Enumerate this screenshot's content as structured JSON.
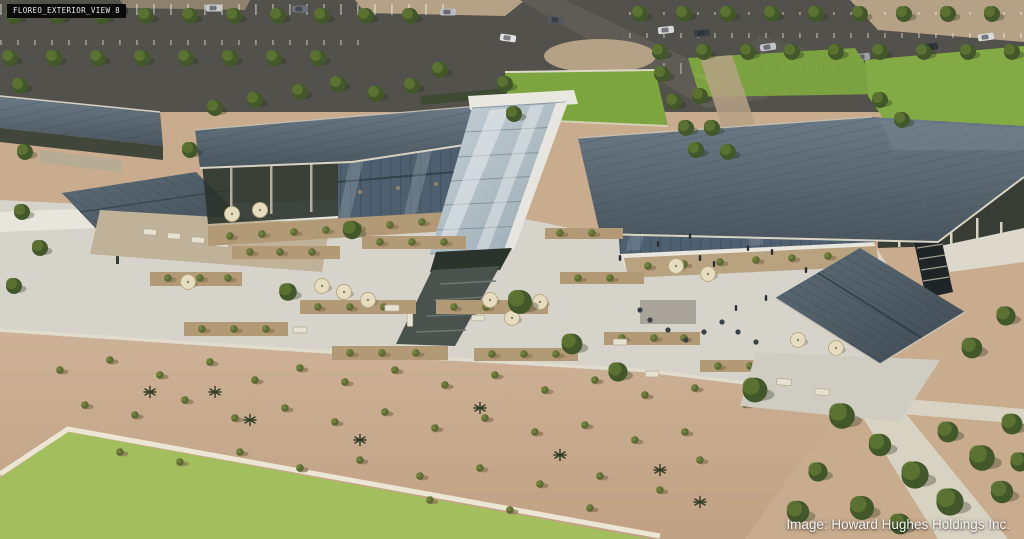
{
  "image": {
    "type": "architectural-aerial-rendering",
    "subject": "Aerial rendering of the Floreo amenity/retail campus: long buildings with dark standing-seam metal roofs, a central glass atrium, outdoor patios with cream umbrellas, shade pavilions, desert landscaping with shrubs and agaves, bright lawns, and tree-lined parking lots.",
    "view_tag": "FLOREO_EXTERIOR_VIEW 8",
    "credit_label": "Image: Howard Hughes Holdings Inc."
  },
  "palette": {
    "asphalt": "#53514b",
    "roof_slate": "#56646f",
    "roof_slate_dark": "#46535d",
    "glass_canopy": "#b8c5cd",
    "facade_glass": "#4e6070",
    "plaza_concrete": "#d6d3cb",
    "walkway_white": "#e9e6dd",
    "gravel_tan": "#b39a76",
    "desert_sand": "#c9ab8e",
    "lawn_green": "#7da53f",
    "lawn_light": "#a3bf5d",
    "tree_green": "#42582a",
    "umbrella_cream": "#e6dcc0",
    "tag_background": "#0b0b0c",
    "tag_text": "#ececec",
    "credit_text": "#f5f5f3"
  }
}
